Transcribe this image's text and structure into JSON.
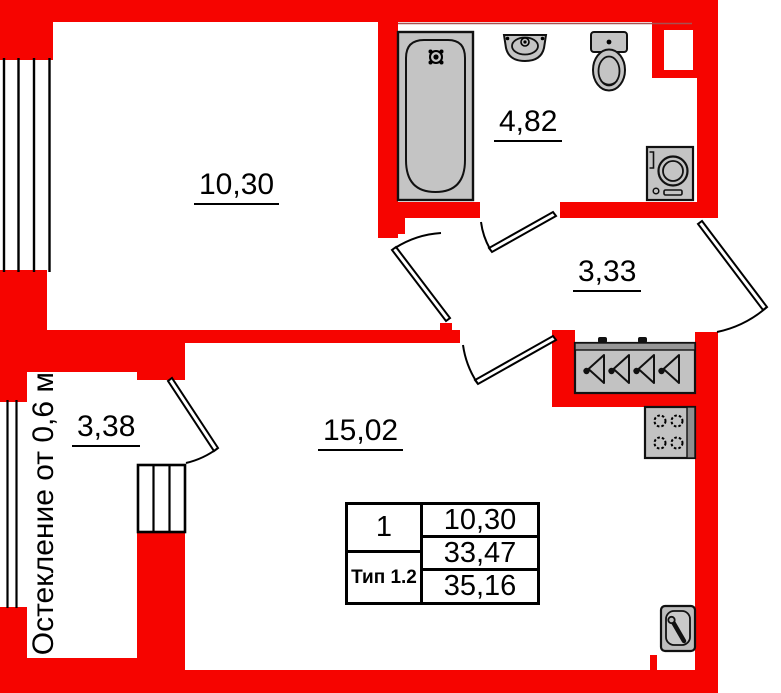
{
  "plan": {
    "title": "apartment-floor-plan",
    "rooms": {
      "bedroom": "10,30",
      "bathroom": "4,82",
      "hallway": "3,33",
      "balcony": "3,38",
      "living": "15,02"
    },
    "note_vertical": "Остекление от 0,6 м",
    "info_table": {
      "rooms_count": "1",
      "type_label": "Тип 1.2",
      "rows": [
        "10,30",
        "33,47",
        "35,16"
      ]
    },
    "icons": [
      "bathtub-icon",
      "washbasin-icon",
      "toilet-icon",
      "washing-machine-icon",
      "wardrobe-hangers-icon",
      "stove-icon",
      "kitchen-sink-icon",
      "door-swing-icon",
      "window-icon"
    ],
    "colors": {
      "wall": "#f60400",
      "fixture_fill": "#c4c4c4",
      "fixture_dark": "#8f8f8f",
      "outline": "#000000",
      "background": "#ffffff"
    }
  }
}
